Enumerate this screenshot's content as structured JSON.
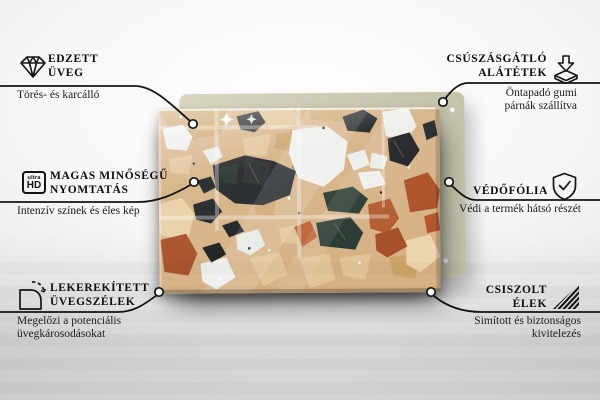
{
  "palette": {
    "text_color": "#111111",
    "line_color": "#141414",
    "board_color": "#cecbb6",
    "terrazzo_base": "#d6b184",
    "terrazzo_black": "#1d2023",
    "terrazzo_white": "#eff0ec",
    "terrazzo_terracotta": "#ab5026",
    "terrazzo_green": "#2a3b31",
    "terrazzo_cream": "#e8d0a6"
  },
  "callouts": [
    {
      "id": "tempered-glass",
      "icon": "diamond-icon",
      "title_lines": [
        "EDZETT",
        "ÜVEG"
      ],
      "subtitle_lines": [
        "Törés- és karcálló"
      ]
    },
    {
      "id": "anti-slip-pads",
      "icon": "slip-pad-arrow-icon",
      "title_lines": [
        "CSÚSZÁSGÁTLÓ",
        "ALÁTÉTEK"
      ],
      "subtitle_lines": [
        "Öntapadó gumi",
        "párnák szállítva"
      ]
    },
    {
      "id": "high-quality-print",
      "icon": "ultra-hd-icon",
      "icon_text": {
        "top": "ultra",
        "bottom": "HD"
      },
      "title_lines": [
        "MAGAS MINŐSÉGŰ",
        "NYOMTATÁS"
      ],
      "subtitle_lines": [
        "Intenzív színek és éles kép"
      ]
    },
    {
      "id": "protective-film",
      "icon": "shield-check-icon",
      "title_lines": [
        "VÉDŐFÓLIA"
      ],
      "subtitle_lines": [
        "Védi a termék hátsó részét"
      ]
    },
    {
      "id": "rounded-glass-edges",
      "icon": "rounded-corner-icon",
      "title_lines": [
        "LEKEREKÍTETT",
        "ÜVEGSZÉLEK"
      ],
      "subtitle_lines": [
        "Megelőzi a potenciális",
        "üvegkárosodásokat"
      ]
    },
    {
      "id": "polished-edges",
      "icon": "diagonal-hatch-icon",
      "title_lines": [
        "CSISZOLT",
        "ÉLEK"
      ],
      "subtitle_lines": [
        "Simított és biztonságos",
        "kivitelezés"
      ]
    }
  ]
}
